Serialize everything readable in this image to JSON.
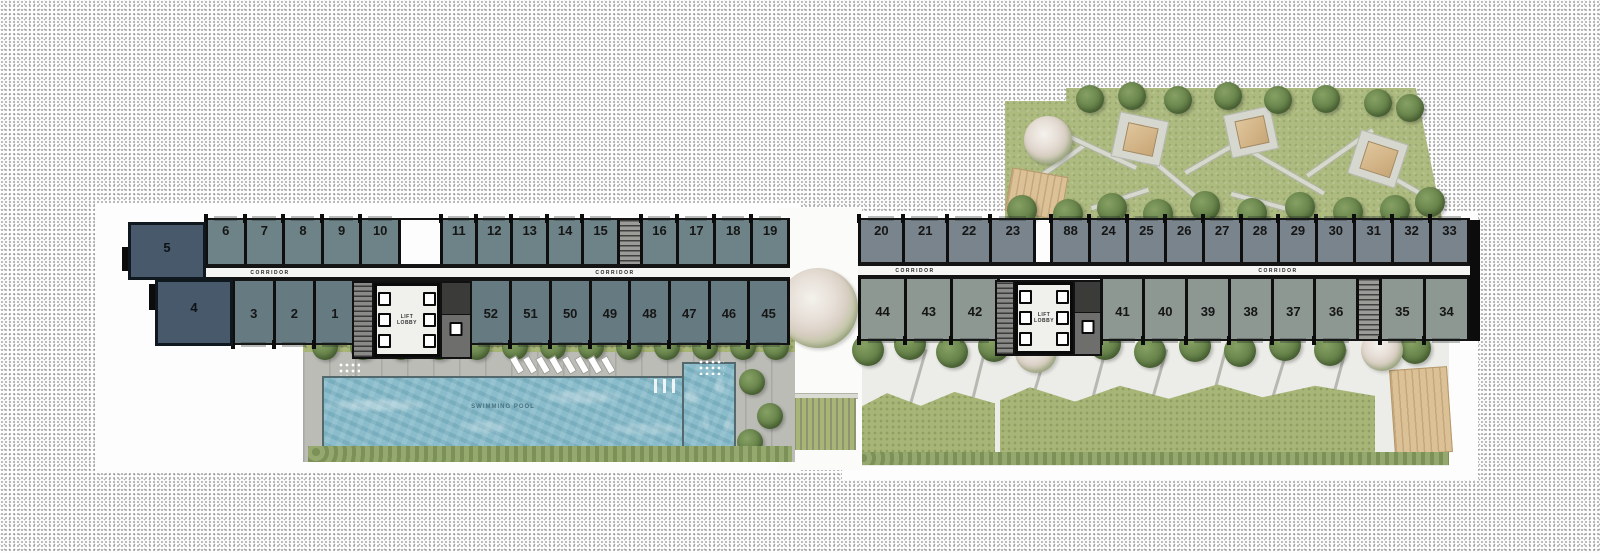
{
  "plan": {
    "corridor_label": "CORRIDOR",
    "lift_lobby_label": "LIFT LOBBY",
    "pool_label": "SWIMMING POOL",
    "colors": {
      "end_unit_navy": "#47596b",
      "left_wing_top": "#6d8387",
      "left_wing_bottom": "#667b81",
      "right_wing_top": "#7a848c",
      "right_wing_bottom": "#8e9892",
      "water": "#8abccb",
      "lawn": "#a7b577",
      "deck": "#bcbcb7",
      "wall": "#0f0f0f",
      "pavilion": "#d3b487"
    },
    "wings": [
      {
        "name": "left-wing",
        "unit_rows": [
          {
            "id": "left-wing-top-row",
            "side": "top",
            "x": 205,
            "y": 218,
            "w": 585,
            "h": 48,
            "color": "#6d8387",
            "segments": [
              {
                "type": "units",
                "w": 192,
                "labels": [
                  "6",
                  "7",
                  "8",
                  "9",
                  "10"
                ]
              },
              {
                "type": "open",
                "w": 45
              },
              {
                "type": "units",
                "w": 176,
                "labels": [
                  "11",
                  "12",
                  "13",
                  "14",
                  "15"
                ]
              },
              {
                "type": "stair",
                "w": 26
              },
              {
                "type": "units",
                "w": 146,
                "labels": [
                  "16",
                  "17",
                  "18",
                  "19"
                ]
              }
            ]
          },
          {
            "id": "left-wing-bottom-row",
            "side": "bottom",
            "x": 232,
            "y": 279,
            "w": 558,
            "h": 66,
            "color": "#667b81",
            "segments": [
              {
                "type": "units",
                "w": 120,
                "labels": [
                  "3",
                  "2",
                  "1"
                ]
              },
              {
                "type": "open",
                "w": 120
              },
              {
                "type": "units",
                "w": 318,
                "labels": [
                  "52",
                  "51",
                  "50",
                  "49",
                  "48",
                  "47",
                  "46",
                  "45"
                ]
              }
            ]
          }
        ],
        "corridor": {
          "x": 155,
          "y": 266,
          "w": 635,
          "h": 13,
          "label_positions": [
            270,
            615
          ]
        },
        "end_units": [
          {
            "label": "5",
            "x": 128,
            "y": 222,
            "w": 78,
            "h": 58
          },
          {
            "label": "4",
            "x": 155,
            "y": 279,
            "w": 78,
            "h": 67
          }
        ],
        "lobby": {
          "x": 352,
          "y": 281,
          "w": 120,
          "h": 78
        },
        "end_wall": null
      },
      {
        "name": "right-wing",
        "unit_rows": [
          {
            "id": "right-wing-top-row",
            "side": "top",
            "x": 858,
            "y": 218,
            "w": 612,
            "h": 46,
            "color": "#7a848c",
            "segments": [
              {
                "type": "units",
                "w": 174,
                "labels": [
                  "20",
                  "21",
                  "22",
                  "23"
                ]
              },
              {
                "type": "open",
                "w": 20
              },
              {
                "type": "units",
                "w": 418,
                "labels": [
                  "88",
                  "24",
                  "25",
                  "26",
                  "27",
                  "28",
                  "29",
                  "30",
                  "31",
                  "32",
                  "33"
                ]
              }
            ]
          },
          {
            "id": "right-wing-bottom-row",
            "side": "bottom",
            "x": 858,
            "y": 277,
            "w": 612,
            "h": 64,
            "color": "#8e9892",
            "segments": [
              {
                "type": "units",
                "w": 137,
                "labels": [
                  "44",
                  "43",
                  "42"
                ]
              },
              {
                "type": "open",
                "w": 107
              },
              {
                "type": "units",
                "w": 256,
                "labels": [
                  "41",
                  "40",
                  "39",
                  "38",
                  "37",
                  "36"
                ]
              },
              {
                "type": "stair",
                "w": 26
              },
              {
                "type": "units",
                "w": 86,
                "labels": [
                  "35",
                  "34"
                ]
              }
            ]
          }
        ],
        "corridor": {
          "x": 858,
          "y": 264,
          "w": 612,
          "h": 13,
          "label_positions": [
            915,
            1278
          ]
        },
        "end_units": [],
        "lobby": {
          "x": 995,
          "y": 280,
          "w": 107,
          "h": 76
        },
        "end_wall": {
          "x": 1470,
          "y": 220,
          "w": 10,
          "h": 121
        }
      }
    ]
  }
}
